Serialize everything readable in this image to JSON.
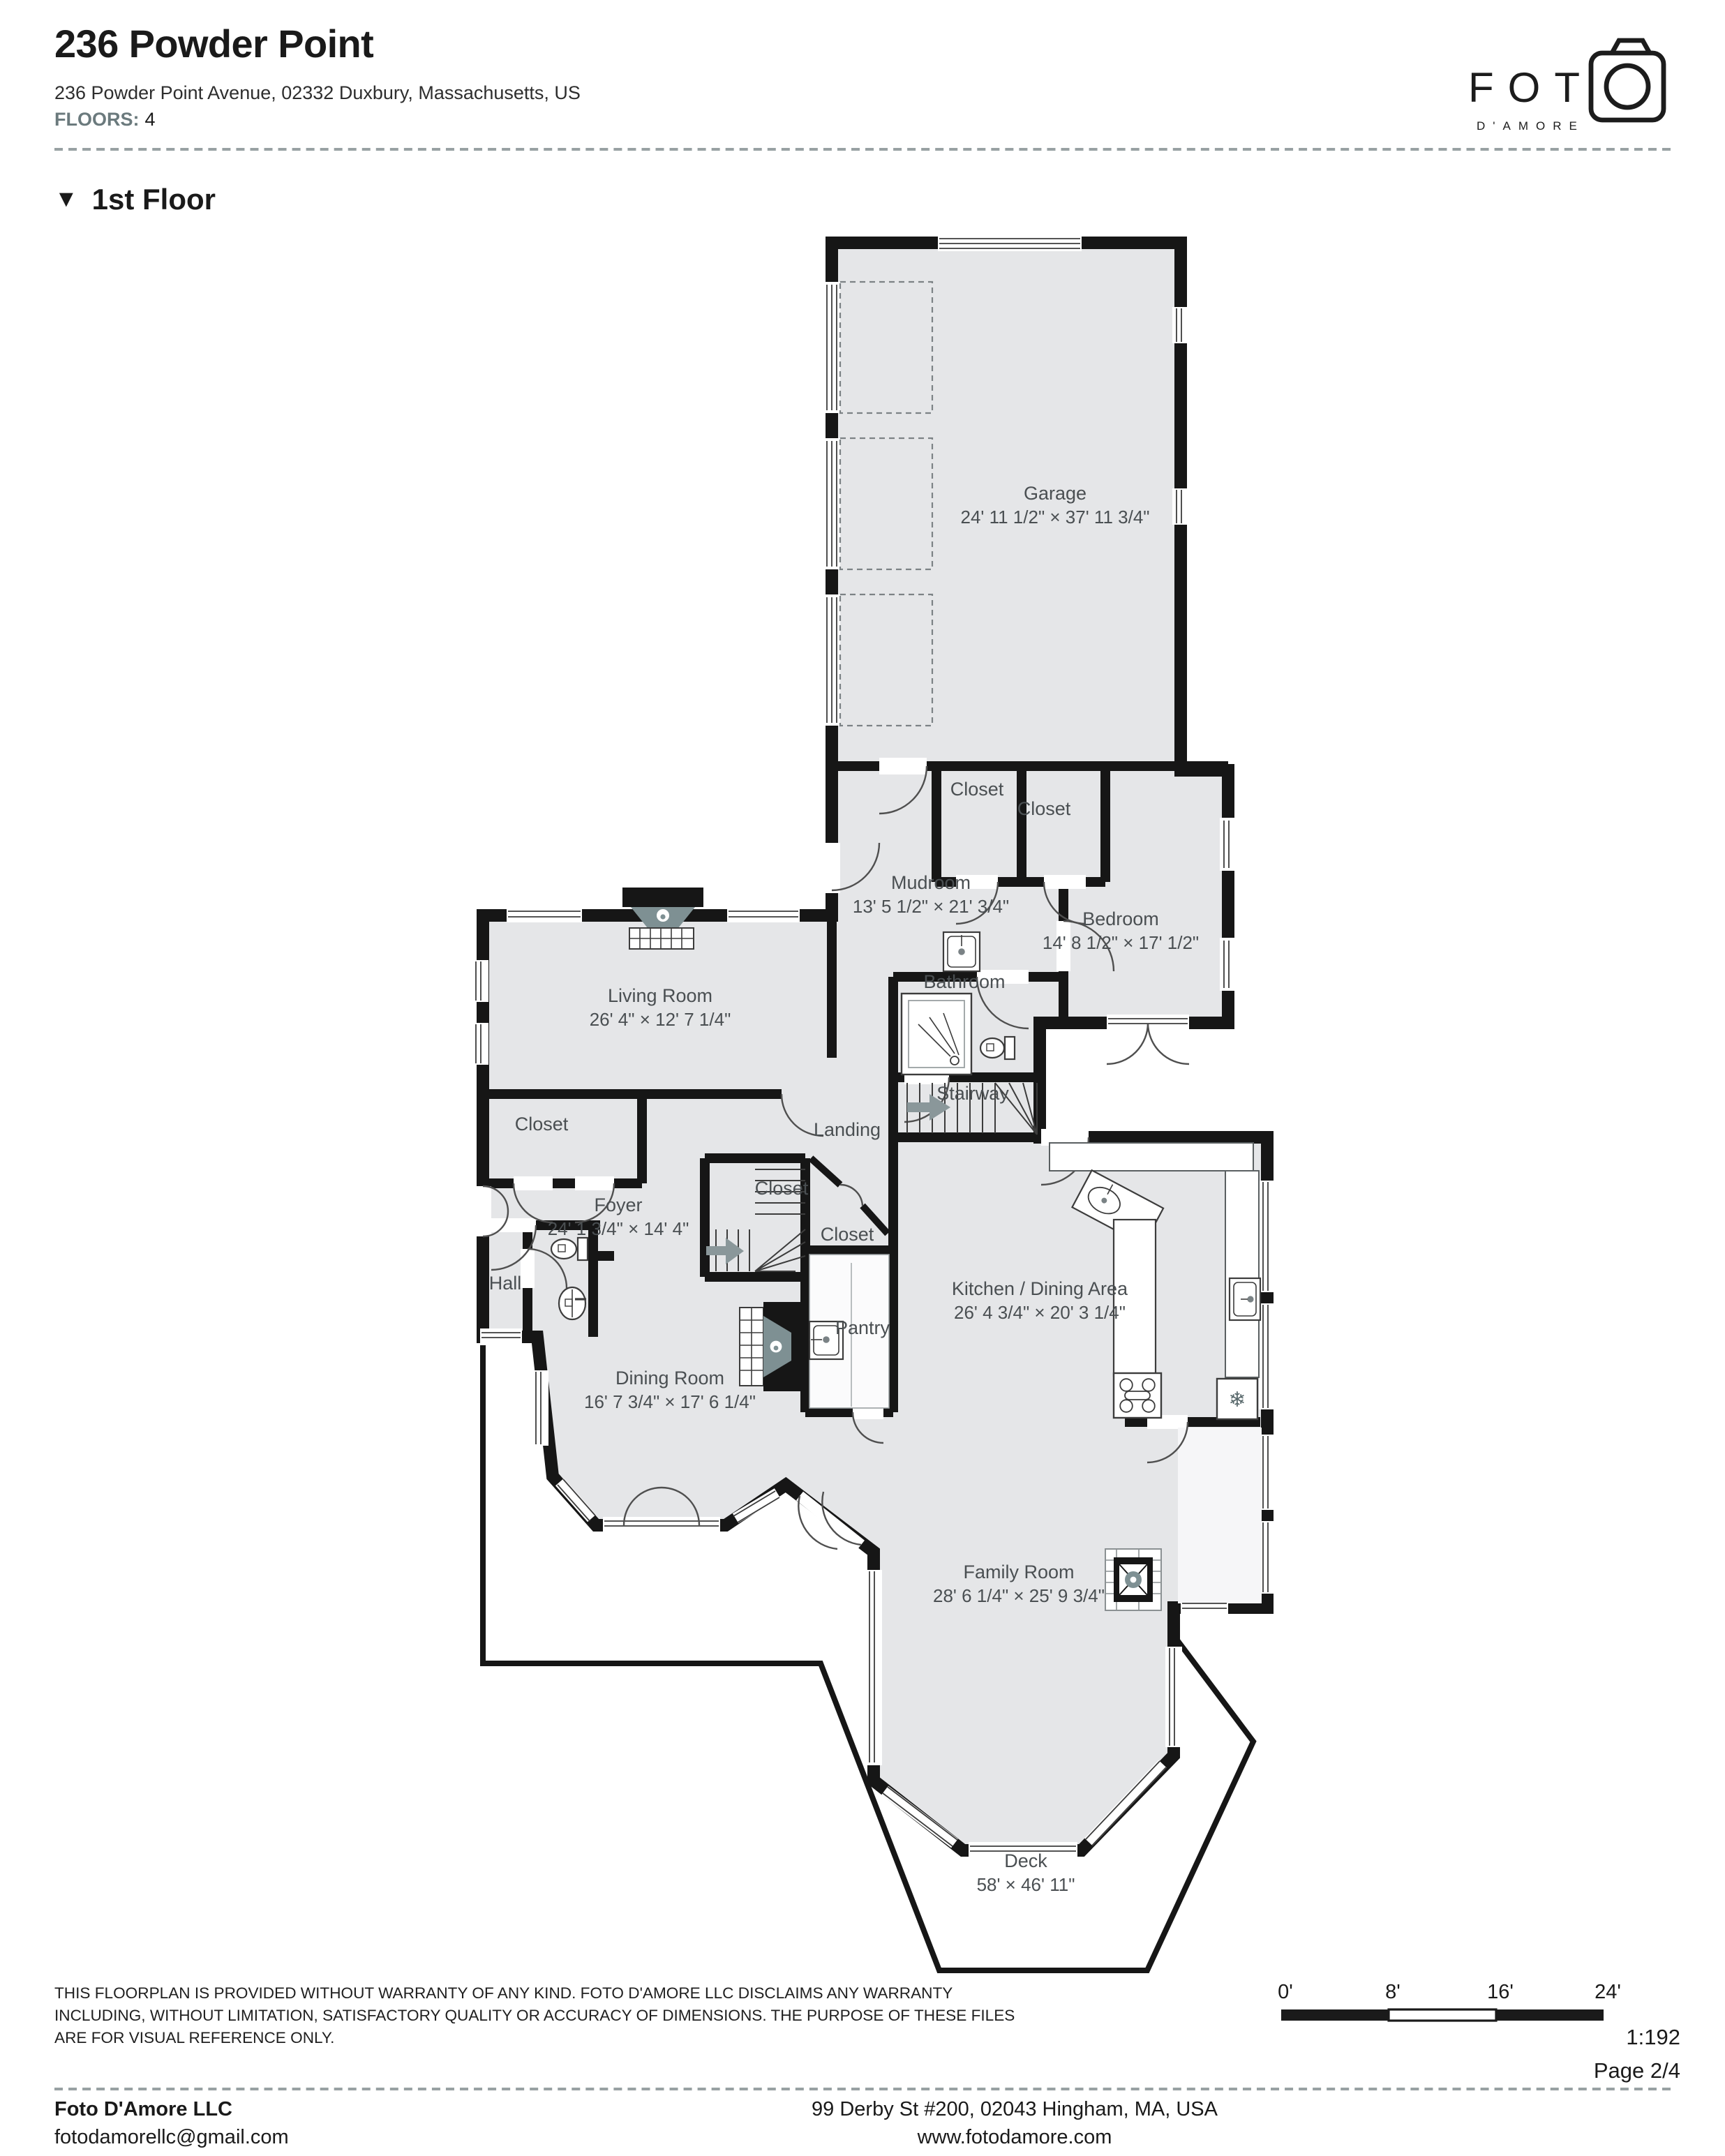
{
  "header": {
    "title": "236 Powder Point",
    "address": "236 Powder Point Avenue, 02332 Duxbury, Massachusetts, US",
    "floors_label": "FLOORS:",
    "floors_value": "4",
    "logo_text": "FOT",
    "logo_sub": "D'AMORE"
  },
  "section": {
    "collapse_icon": "▼",
    "title": "1st Floor"
  },
  "colors": {
    "accent_teal": "#6b7a7d",
    "room_fill": "#e5e6e8",
    "wall": "#161616",
    "label": "#4a4f52",
    "fixture_accent": "#7e9093"
  },
  "rooms": {
    "garage": {
      "name": "Garage",
      "dims": "24' 11 1/2\" × 37' 11 3/4\""
    },
    "closet_mudroom": {
      "name": "Closet"
    },
    "closet_bedroom": {
      "name": "Closet"
    },
    "mudroom": {
      "name": "Mudroom",
      "dims": "13' 5 1/2\" × 21' 3/4\""
    },
    "bedroom": {
      "name": "Bedroom",
      "dims": "14' 8 1/2\" × 17' 1/2\""
    },
    "bathroom": {
      "name": "Bathroom"
    },
    "stairway": {
      "name": "Stairway"
    },
    "landing": {
      "name": "Landing"
    },
    "living_room": {
      "name": "Living Room",
      "dims": "26' 4\" × 12' 7 1/4\""
    },
    "closet_living": {
      "name": "Closet"
    },
    "foyer": {
      "name": "Foyer",
      "dims": "24' 1 3/4\" × 14' 4\""
    },
    "closet_stairs": {
      "name": "Closet"
    },
    "closet_foyer": {
      "name": "Closet"
    },
    "hall": {
      "name": "Hall"
    },
    "kitchen": {
      "name": "Kitchen / Dining Area",
      "dims": "26' 4 3/4\" × 20' 3 1/4\""
    },
    "pantry": {
      "name": "Pantry"
    },
    "dining_room": {
      "name": "Dining Room",
      "dims": "16' 7 3/4\" × 17' 6 1/4\""
    },
    "family_room": {
      "name": "Family Room",
      "dims": "28' 6 1/4\" × 25' 9 3/4\""
    },
    "deck": {
      "name": "Deck",
      "dims": "58' × 46' 11\""
    }
  },
  "footer": {
    "disclaimer_line1": "THIS FLOORPLAN IS PROVIDED WITHOUT WARRANTY OF ANY KIND. FOTO D'AMORE LLC DISCLAIMS ANY WARRANTY",
    "disclaimer_line2": "INCLUDING, WITHOUT LIMITATION, SATISFACTORY QUALITY OR ACCURACY OF DIMENSIONS. THE PURPOSE OF THESE FILES",
    "disclaimer_line3": "ARE FOR VISUAL REFERENCE ONLY.",
    "scale": {
      "t0": "0'",
      "t8": "8'",
      "t16": "16'",
      "t24": "24'"
    },
    "ratio": "1:192",
    "page": "Page 2/4",
    "company": "Foto D'Amore LLC",
    "email": "fotodamorellc@gmail.com",
    "address": "99 Derby St #200, 02043 Hingham, MA, USA",
    "website": "www.fotodamore.com"
  }
}
